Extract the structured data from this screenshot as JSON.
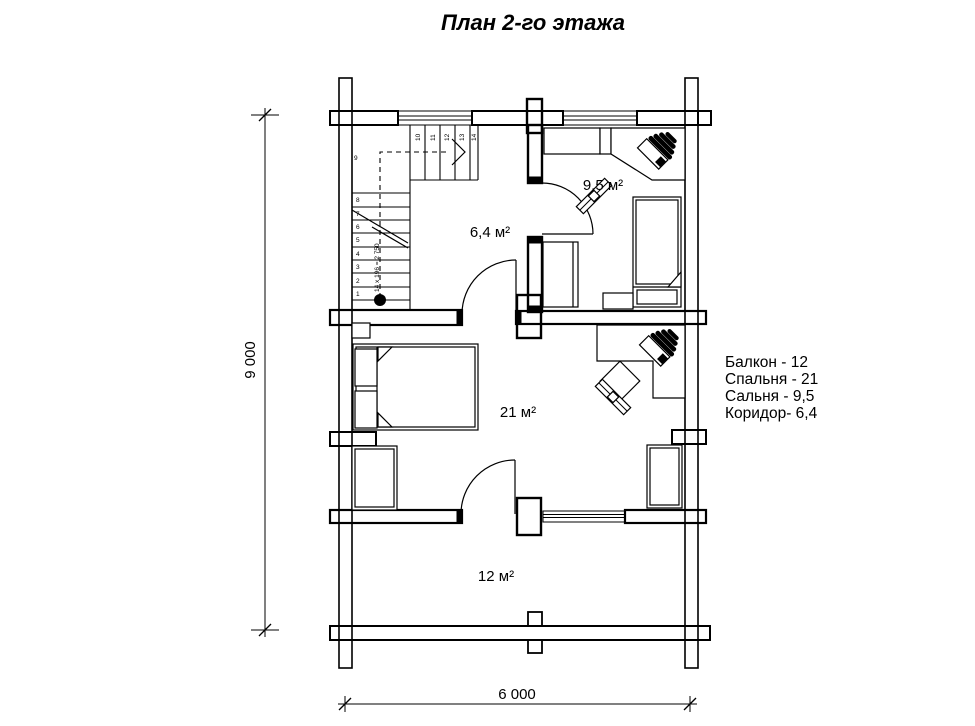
{
  "title": "План 2-го этажа",
  "rooms": [
    {
      "label": "9,5 м²"
    },
    {
      "label": "6,4 м²"
    },
    {
      "label": "21 м²"
    },
    {
      "label": "12 м²"
    }
  ],
  "legend": {
    "items": [
      "Балкон - 12",
      "Спальня - 21",
      "Сальня - 9,5",
      "Коридор- 6,4"
    ]
  },
  "dimensions": {
    "vertical": "9 000",
    "horizontal": "6 000"
  },
  "stairs": {
    "run_label": "14 x 196 = 2 750",
    "steps": [
      "1",
      "2",
      "3",
      "4",
      "5",
      "6",
      "7",
      "8",
      "9",
      "10",
      "11",
      "12",
      "13",
      "14"
    ]
  },
  "colors": {
    "line": "#000000",
    "background": "#ffffff"
  }
}
